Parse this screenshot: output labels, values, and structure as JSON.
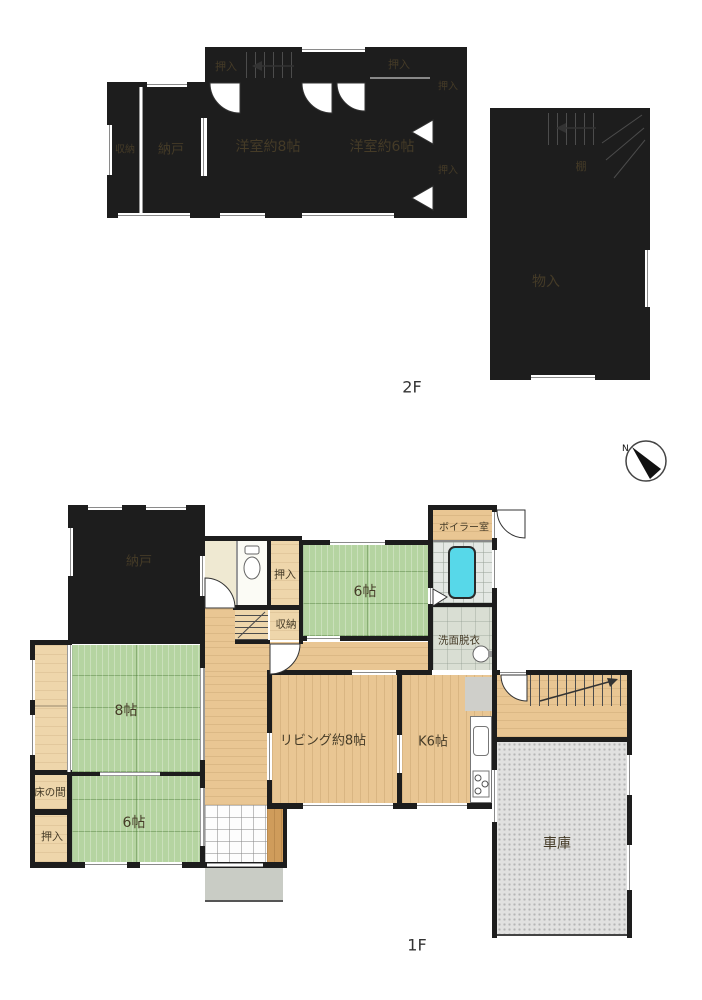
{
  "document_type": "floor-plan",
  "floor2": {
    "floor_label": "2F",
    "rooms": {
      "shunou": "収納",
      "nando": "納戸",
      "oshiire_top_left": "押入",
      "yoshitsu8": "洋室約8帖",
      "yoshitsu6": "洋室約6帖",
      "oshiire_closet": "押入",
      "oshiire_right_upper": "押入",
      "oshiire_right_lower": "押入",
      "monoire": "物入",
      "tana": "棚"
    }
  },
  "floor1": {
    "floor_label": "1F",
    "rooms": {
      "nando": "納戸",
      "oshiire_center": "押入",
      "washitsu6_upper": "6帖",
      "boiler_room": "ボイラー室",
      "senmen_datsui": "洗面脱衣",
      "shunou": "収納",
      "washitsu8": "8帖",
      "living": "リビング約8帖",
      "kitchen": "K6帖",
      "tokonoma": "床の間",
      "oshiire_left": "押入",
      "washitsu6_lower": "6帖",
      "garage": "車庫"
    }
  },
  "compass": {
    "north_label": "N"
  },
  "colors": {
    "wall": "#1d1d1d",
    "wood_floor": "#e9c693",
    "tatami_green": "#b5d4a1",
    "closet_brown": "#bd8443",
    "bathtub_cyan": "#57d8e9",
    "garage_gray": "#e1e1e0"
  }
}
